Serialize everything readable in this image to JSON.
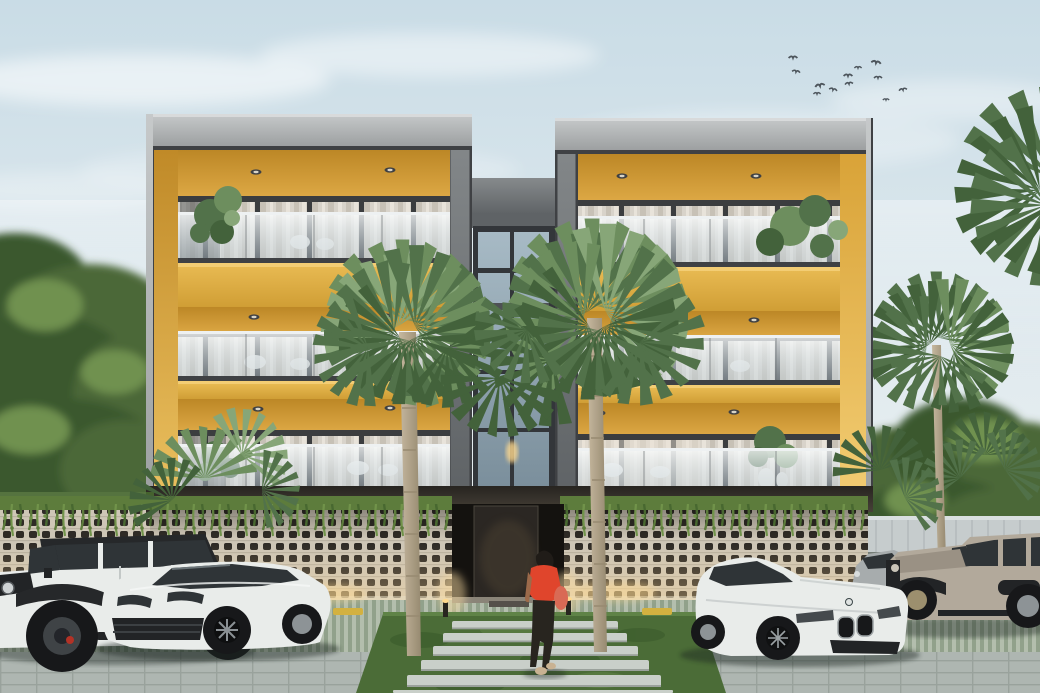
{
  "scene": {
    "type": "architectural exterior rendering",
    "description": "Three-story modern apartment building with two golden-yellow balcony wings flanking a central glass stair tower, perforated breeze-block parking screen with hanging vines, tropical palms, parked luxury cars and a woman walking to the entrance at dusk",
    "building": {
      "floors": 3,
      "wings": 2,
      "balconies_per_wing": 3,
      "balustrade": "frameless glass",
      "accent": "golden yellow soffits and side walls",
      "ground_level": "open parking behind perforated concrete screen",
      "lighting": "recessed soffit downlights and warm uplights at screen base"
    },
    "vehicles": [
      {
        "label": "white Jeep Wrangler with black soft top",
        "position": "far left"
      },
      {
        "label": "white Porsche Cayenne SUV",
        "position": "left of entrance"
      },
      {
        "label": "white BMW 8-series coupe",
        "position": "right of entrance"
      },
      {
        "label": "silver sedan",
        "position": "behind BMW"
      },
      {
        "label": "tan Jeep Wrangler",
        "position": "far right"
      }
    ],
    "person": {
      "label": "woman walking toward entrance",
      "top": "red blouse",
      "bottom": "dark trousers",
      "hair": "long dark ponytail",
      "accessory": "red shoulder bag"
    },
    "landscaping": {
      "center_fan_palms": 2,
      "background_palms": 3,
      "left_tree_mass": true,
      "vines_on_screen_wall": true,
      "grass_entry_path_stones": 6,
      "balcony_plants": 4
    },
    "birds_count": 12,
    "sky": "pale blue with soft clouds"
  },
  "colors": {
    "sky1": "#c9dce6",
    "sky2": "#e2ebef",
    "sky3": "#eef1f0",
    "cloud": "#ffffff",
    "fascia1": "#c6c9ca",
    "fascia2": "#9da0a1",
    "fasciaEdge": "#d8dadb",
    "frameDark": "#3f4144",
    "pillar1": "#909293",
    "pillar2": "#727577",
    "ceil1": "#bc8726",
    "ceil2": "#e2ad49",
    "sideL1": "#c08a28",
    "sideL2": "#eabf5e",
    "sideR1": "#d9a338",
    "sideR2": "#f2cc72",
    "spanLip": "#f3cd74",
    "span1": "#e7b951",
    "span2": "#d09e35",
    "curt1": "#d8d3ca",
    "curt2": "#c7c1b6",
    "curt3": "#e8e3da",
    "mullion": "#3b3d3f",
    "glass1": "#f7fafb",
    "glass2": "#c0cfd8",
    "rail": "#eef1f2",
    "postLine": "#6e7376",
    "towerConc1": "#868a8c",
    "towerConc2": "#5f6366",
    "towerGlass1": "#a7bac5",
    "towerGlass2": "#7b8f9c",
    "towerFrame": "#33363a",
    "under1": "#272420",
    "under2": "#474138",
    "breezeBg": "#cec6b6",
    "breezeHole": "#2f2b26",
    "breezeLine": "#b9b1a1",
    "vine1": "#5d7c3c",
    "vine2": "#71934a",
    "vine3": "#486830",
    "tree1": "#4c6838",
    "tree2": "#3b582d",
    "tree3": "#6f9150",
    "palm1": "#6d8e5e",
    "palm2": "#52724a",
    "palm3": "#87a678",
    "palm4": "#43623b",
    "trunk1": "#c6b89f",
    "trunk2": "#978a71",
    "wallL": "#b6bcb7",
    "wallLcap": "#ccd1cc",
    "wallR": "#c6cccd",
    "wallRline": "#aeb5b7",
    "ground1": "#9aa59c",
    "stripe1": "#b6c1af",
    "stripe2": "#90a189",
    "apron": "#aeb6b1",
    "apronLine": "#99a29c",
    "grass1": "#4b6c37",
    "grass2": "#3a5a2b",
    "grass3": "#5f8347",
    "stone": "#c9cfc9",
    "stoneEdge": "#9aa19b",
    "curb": "#d3b140",
    "carWhite": "#e9ecea",
    "carWhiteShade": "#c6cbca",
    "carGlass": "#2f3437",
    "tire": "#17181a",
    "rim": "#8d9396",
    "detailDark": "#222426",
    "jeepTopBlack": "#26282a",
    "jeepTan": "#b2a99b",
    "jeepTanDark": "#9a9184",
    "sedanGray": "#a7acad",
    "red": "#e0452c",
    "bagRed": "#d96a55",
    "skin": "#9c6a4a",
    "hair": "#201c18",
    "pants": "#28251f",
    "shoe": "#c9b292",
    "door": "#2b2723",
    "doorRecess": "#14120f",
    "threshold": "#8a8478",
    "glow": "#ffd98e",
    "lightLens": "#d8d4c8",
    "bird": "#4d555c",
    "shadow": "#1e2620"
  }
}
